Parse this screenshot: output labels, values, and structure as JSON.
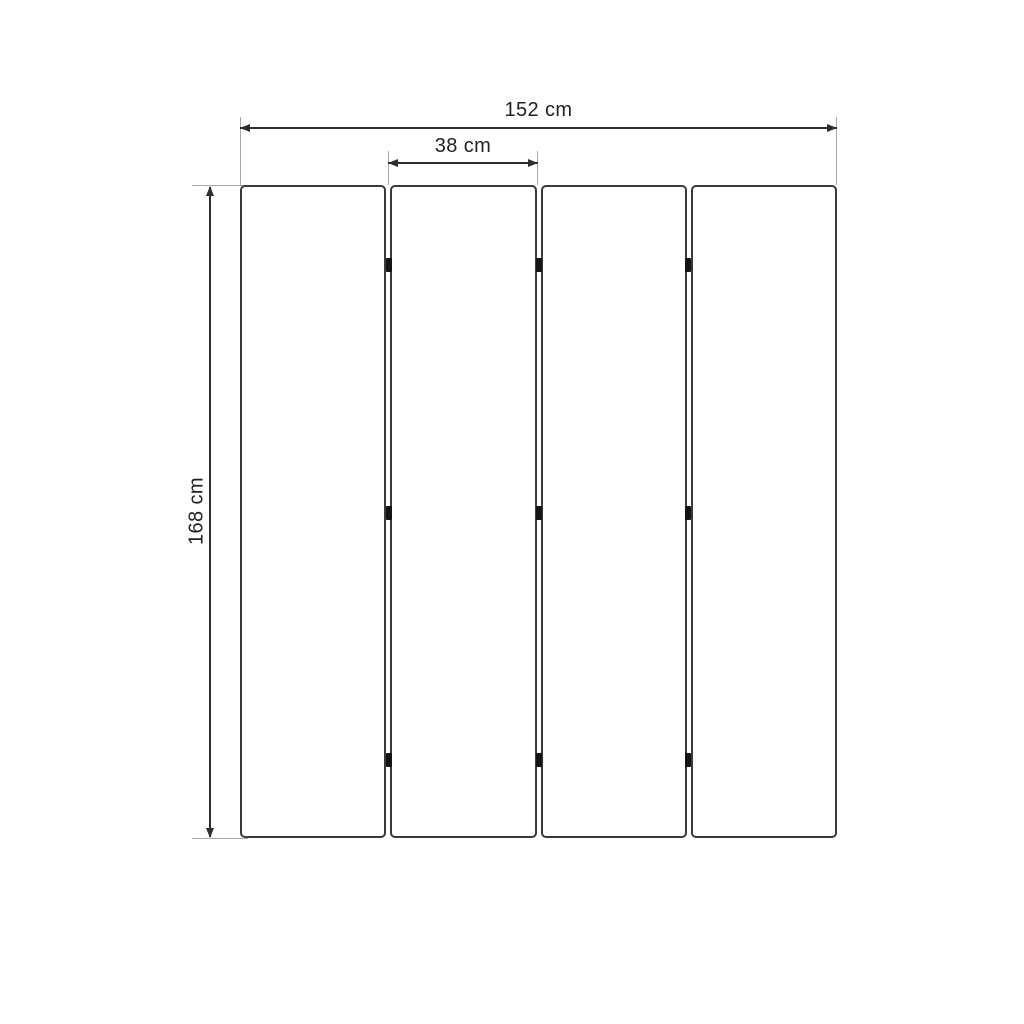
{
  "drawing": {
    "type": "dimensioned-technical-drawing",
    "subject": "four-panel-folding-screen",
    "panels": {
      "count": 4,
      "joints": 3,
      "hinge_rows_per_joint": 3
    },
    "dimensions": {
      "width_total": {
        "label": "152 cm",
        "value": 152,
        "unit": "cm"
      },
      "panel_width": {
        "label": "38 cm",
        "value": 38,
        "unit": "cm"
      },
      "height": {
        "label": "168 cm",
        "value": 168,
        "unit": "cm"
      }
    },
    "colors": {
      "background": "#ffffff",
      "panel_border": "#3a3a3a",
      "dimension_line": "#2e2e2e",
      "extension_line": "#a8a8a8",
      "hinge": "#141414",
      "text": "#212121"
    }
  }
}
